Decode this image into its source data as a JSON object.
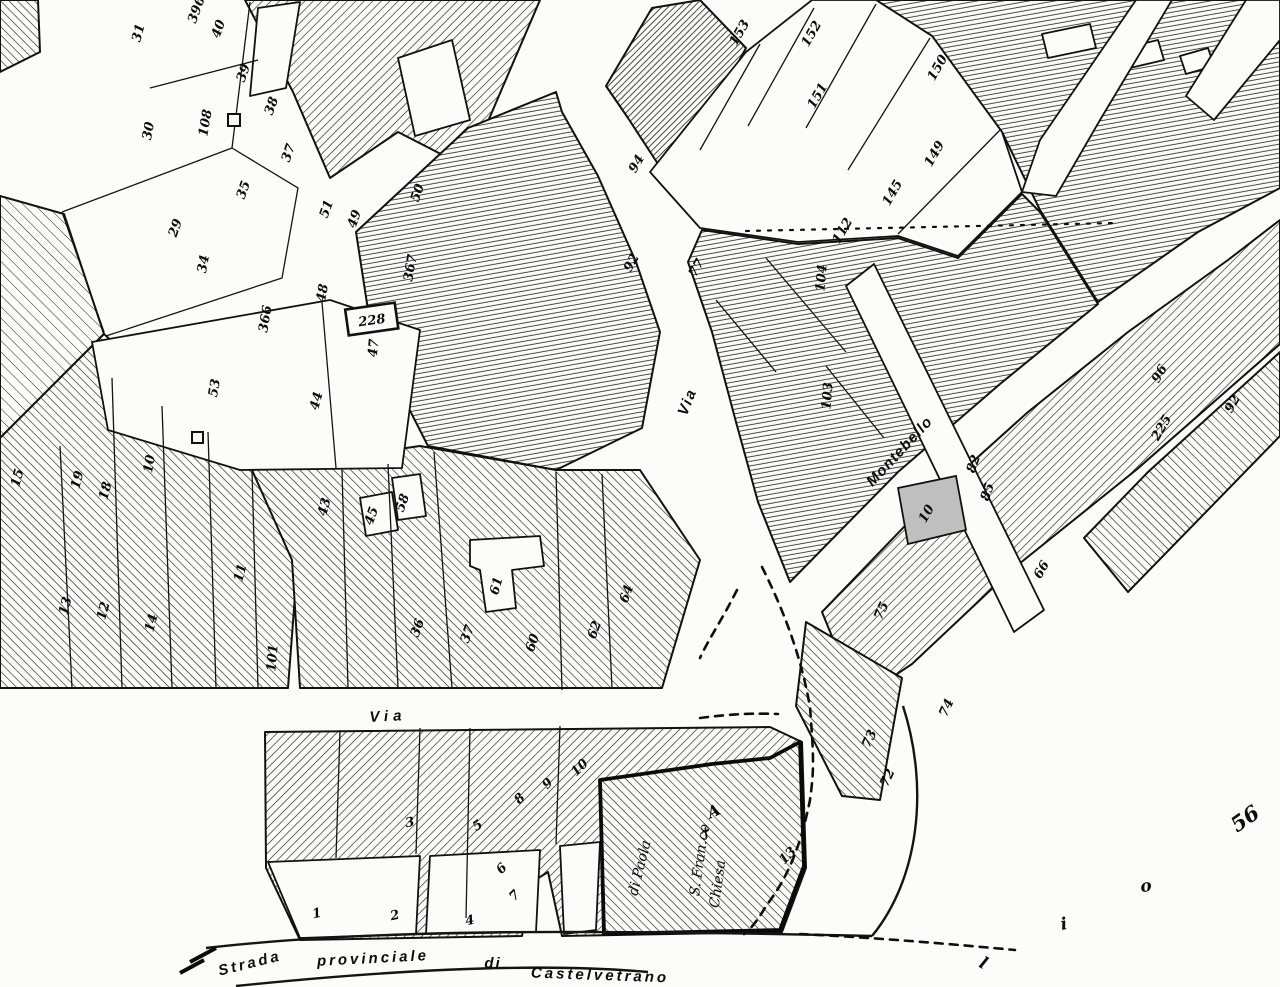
{
  "map": {
    "kind": "scanned cadastral town map (black ink on white paper)",
    "colors": {
      "ink": "#111111",
      "paper": "#fcfcfa",
      "shaded_parcel": "#bfbfbf"
    },
    "street_labels": [
      {
        "t": "Via",
        "x": 388,
        "y": 717,
        "r": -3,
        "sp": 5
      },
      {
        "t": "Via",
        "x": 688,
        "y": 402,
        "r": -68,
        "sp": 2
      },
      {
        "t": "Montebello",
        "x": 900,
        "y": 452,
        "r": -47,
        "sp": 1
      },
      {
        "t": "Strada",
        "x": 250,
        "y": 964,
        "r": -14,
        "sp": 3
      },
      {
        "t": "provinciale",
        "x": 373,
        "y": 959,
        "r": -3,
        "sp": 3
      },
      {
        "t": "di",
        "x": 493,
        "y": 964,
        "r": 0,
        "sp": 2
      },
      {
        "t": "Castelvetrano",
        "x": 600,
        "y": 976,
        "r": 2,
        "sp": 3
      }
    ],
    "parcel_numbers": [
      {
        "n": "396",
        "x": 197,
        "y": 10,
        "r": -70
      },
      {
        "n": "31",
        "x": 139,
        "y": 33,
        "r": -75
      },
      {
        "n": "40",
        "x": 219,
        "y": 29,
        "r": -70
      },
      {
        "n": "39",
        "x": 244,
        "y": 73,
        "r": -70
      },
      {
        "n": "38",
        "x": 272,
        "y": 106,
        "r": -70
      },
      {
        "n": "37",
        "x": 289,
        "y": 153,
        "r": -70
      },
      {
        "n": "35",
        "x": 244,
        "y": 190,
        "r": -70
      },
      {
        "n": "30",
        "x": 149,
        "y": 131,
        "r": -80
      },
      {
        "n": "108",
        "x": 206,
        "y": 123,
        "r": -80
      },
      {
        "n": "29",
        "x": 176,
        "y": 228,
        "r": -70
      },
      {
        "n": "34",
        "x": 204,
        "y": 264,
        "r": -80
      },
      {
        "n": "51",
        "x": 327,
        "y": 209,
        "r": -70
      },
      {
        "n": "49",
        "x": 355,
        "y": 219,
        "r": -70
      },
      {
        "n": "50",
        "x": 418,
        "y": 193,
        "r": -70
      },
      {
        "n": "48",
        "x": 323,
        "y": 293,
        "r": -80
      },
      {
        "n": "47",
        "x": 374,
        "y": 348,
        "r": -85
      },
      {
        "n": "367",
        "x": 411,
        "y": 268,
        "r": -80
      },
      {
        "n": "366",
        "x": 266,
        "y": 319,
        "r": -80
      },
      {
        "n": "228",
        "x": 372,
        "y": 321,
        "r": -8,
        "box": true
      },
      {
        "n": "53",
        "x": 215,
        "y": 388,
        "r": -80
      },
      {
        "n": "44",
        "x": 317,
        "y": 401,
        "r": -75
      },
      {
        "n": "43",
        "x": 325,
        "y": 507,
        "r": -75
      },
      {
        "n": "19",
        "x": 78,
        "y": 480,
        "r": -75
      },
      {
        "n": "18",
        "x": 106,
        "y": 491,
        "r": -75
      },
      {
        "n": "10",
        "x": 150,
        "y": 464,
        "r": -80
      },
      {
        "n": "15",
        "x": 18,
        "y": 478,
        "r": -75
      },
      {
        "n": "13",
        "x": 66,
        "y": 606,
        "r": -75
      },
      {
        "n": "12",
        "x": 104,
        "y": 611,
        "r": -75
      },
      {
        "n": "14",
        "x": 152,
        "y": 623,
        "r": -75
      },
      {
        "n": "11",
        "x": 241,
        "y": 573,
        "r": -75
      },
      {
        "n": "101",
        "x": 273,
        "y": 658,
        "r": -85
      },
      {
        "n": "45",
        "x": 372,
        "y": 516,
        "r": -70
      },
      {
        "n": "58",
        "x": 403,
        "y": 503,
        "r": -70
      },
      {
        "n": "61",
        "x": 497,
        "y": 586,
        "r": -75
      },
      {
        "n": "36",
        "x": 418,
        "y": 628,
        "r": -70
      },
      {
        "n": "37",
        "x": 468,
        "y": 634,
        "r": -70
      },
      {
        "n": "60",
        "x": 533,
        "y": 643,
        "r": -70
      },
      {
        "n": "62",
        "x": 595,
        "y": 630,
        "r": -70
      },
      {
        "n": "64",
        "x": 627,
        "y": 594,
        "r": -70
      },
      {
        "n": "94",
        "x": 637,
        "y": 164,
        "r": -60
      },
      {
        "n": "92",
        "x": 632,
        "y": 263,
        "r": -60
      },
      {
        "n": "77",
        "x": 697,
        "y": 268,
        "r": -60
      },
      {
        "n": "153",
        "x": 740,
        "y": 33,
        "r": -60
      },
      {
        "n": "152",
        "x": 812,
        "y": 34,
        "r": -60
      },
      {
        "n": "151",
        "x": 818,
        "y": 96,
        "r": -60
      },
      {
        "n": "150",
        "x": 938,
        "y": 68,
        "r": -60
      },
      {
        "n": "149",
        "x": 935,
        "y": 154,
        "r": -60
      },
      {
        "n": "145",
        "x": 893,
        "y": 193,
        "r": -60
      },
      {
        "n": "112",
        "x": 843,
        "y": 231,
        "r": -60
      },
      {
        "n": "104",
        "x": 822,
        "y": 278,
        "r": -85
      },
      {
        "n": "103",
        "x": 828,
        "y": 396,
        "r": -85
      },
      {
        "n": "10",
        "x": 927,
        "y": 514,
        "r": -60
      },
      {
        "n": "96",
        "x": 1160,
        "y": 374,
        "r": -60
      },
      {
        "n": "92",
        "x": 1233,
        "y": 404,
        "r": -60
      },
      {
        "n": "225",
        "x": 1162,
        "y": 428,
        "r": -60
      },
      {
        "n": "82",
        "x": 974,
        "y": 464,
        "r": -70
      },
      {
        "n": "85",
        "x": 988,
        "y": 492,
        "r": -70
      },
      {
        "n": "66",
        "x": 1042,
        "y": 570,
        "r": -60
      },
      {
        "n": "75",
        "x": 882,
        "y": 611,
        "r": -65
      },
      {
        "n": "74",
        "x": 947,
        "y": 708,
        "r": -65
      },
      {
        "n": "73",
        "x": 870,
        "y": 739,
        "r": -65
      },
      {
        "n": "72",
        "x": 888,
        "y": 778,
        "r": -65
      },
      {
        "n": "1",
        "x": 317,
        "y": 914,
        "r": -12
      },
      {
        "n": "2",
        "x": 395,
        "y": 916,
        "r": -12
      },
      {
        "n": "3",
        "x": 410,
        "y": 823,
        "r": -12
      },
      {
        "n": "4",
        "x": 470,
        "y": 921,
        "r": -12
      },
      {
        "n": "5",
        "x": 478,
        "y": 826,
        "r": -35
      },
      {
        "n": "6",
        "x": 502,
        "y": 869,
        "r": -45
      },
      {
        "n": "7",
        "x": 515,
        "y": 896,
        "r": -45
      },
      {
        "n": "8",
        "x": 520,
        "y": 799,
        "r": -45
      },
      {
        "n": "9",
        "x": 548,
        "y": 784,
        "r": -45
      },
      {
        "n": "10",
        "x": 580,
        "y": 768,
        "r": -45
      },
      {
        "n": "13",
        "x": 788,
        "y": 856,
        "r": -45
      }
    ],
    "annotations": [
      {
        "t": "56",
        "x": 1246,
        "y": 820,
        "r": -35,
        "cls": "big-hand"
      },
      {
        "t": "o",
        "x": 1146,
        "y": 887,
        "r": -10,
        "cls": "letter"
      },
      {
        "t": "i",
        "x": 1064,
        "y": 925,
        "r": -10,
        "cls": "letter"
      },
      {
        "t": "l",
        "x": 983,
        "y": 964,
        "r": 28,
        "cls": "letter"
      },
      {
        "t": "A",
        "x": 714,
        "y": 812,
        "r": -25,
        "cls": "marker"
      },
      {
        "t": "✝",
        "x": 705,
        "y": 834,
        "r": -20,
        "cls": "hand"
      },
      {
        "t": "Chiesa",
        "x": 718,
        "y": 884,
        "r": -82,
        "cls": "hand"
      },
      {
        "t": "S. Fran.co",
        "x": 700,
        "y": 860,
        "r": -82,
        "cls": "hand"
      },
      {
        "t": "di Paola",
        "x": 640,
        "y": 868,
        "r": -76,
        "cls": "hand"
      }
    ]
  }
}
